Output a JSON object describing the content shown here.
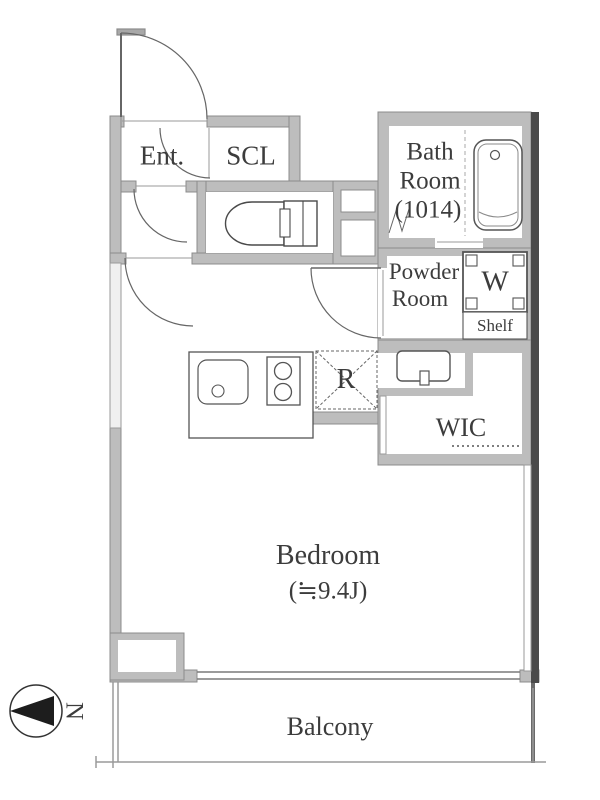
{
  "plan_type": "apartment-floorplan",
  "rooms": {
    "entrance": "Ent.",
    "shoe_closet": "SCL",
    "bathroom_lines": [
      "Bath",
      "Room",
      "(1014)"
    ],
    "powder_lines": [
      "Powder",
      "Room"
    ],
    "washer": "W",
    "shelf": "Shelf",
    "wic": "WIC",
    "refrigerator": "R",
    "bedroom": "Bedroom",
    "bedroom_size": "(≒9.4J)",
    "balcony": "Balcony"
  },
  "compass": {
    "label": "N",
    "points": "left"
  },
  "fixtures": [
    "entrance-door",
    "scl-door",
    "hall-door",
    "bedroom-door",
    "powder-door",
    "bath-folding-door",
    "toilet",
    "bathtub",
    "washing-machine-pan",
    "shelf",
    "washbasin",
    "kitchen-sink",
    "stove-2-burner",
    "refrigerator-space",
    "wic-hanger-rail",
    "pipe-space",
    "south-window",
    "west-window"
  ],
  "colors": {
    "background": "#ffffff",
    "wall_fill": "#bdbdbd",
    "wall_stroke": "#8c8c8c",
    "outer_edge": "#4a4a4a",
    "line": "#555555",
    "text": "#3c3c3c"
  }
}
